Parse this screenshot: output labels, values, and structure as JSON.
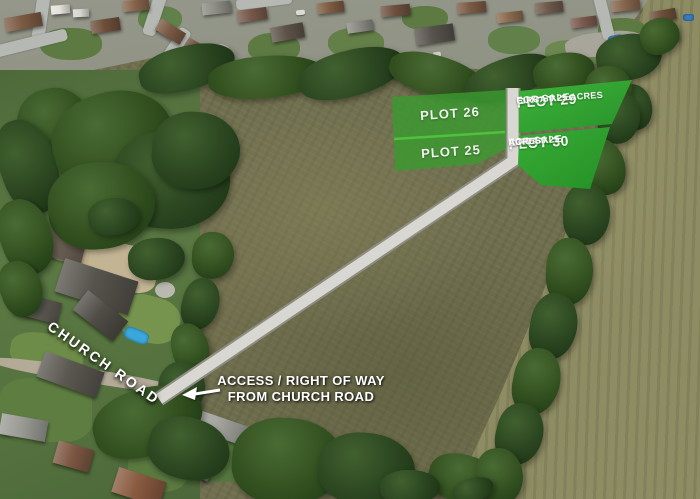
{
  "plots": {
    "p26": {
      "name": "PLOT 26"
    },
    "p25": {
      "name": "PLOT 25"
    },
    "p29": {
      "name": "PLOT 29",
      "status": "FOR SALE",
      "size": "CIRCA 0.25 ACRES"
    },
    "p30": {
      "name": "PLOT 30",
      "status": "FOR SALE",
      "size_line1": "CIRCA 0.25",
      "size_line2": "ACRES"
    }
  },
  "annotations": {
    "road_name": "CHURCH ROAD",
    "access_line1": "ACCESS / RIGHT OF WAY",
    "access_line2": "FROM CHURCH ROAD"
  },
  "colors": {
    "plot_bright_green_light": "#3db33a",
    "plot_bright_green_dark": "#28922a",
    "plot_overlay_green": "#3a9a30",
    "plot_divider_green": "#4fc13c",
    "track_gray": "#d8d7d1",
    "annotation_white": "#ffffff"
  },
  "icons": {
    "access_arrow": "left-arrow-icon"
  }
}
